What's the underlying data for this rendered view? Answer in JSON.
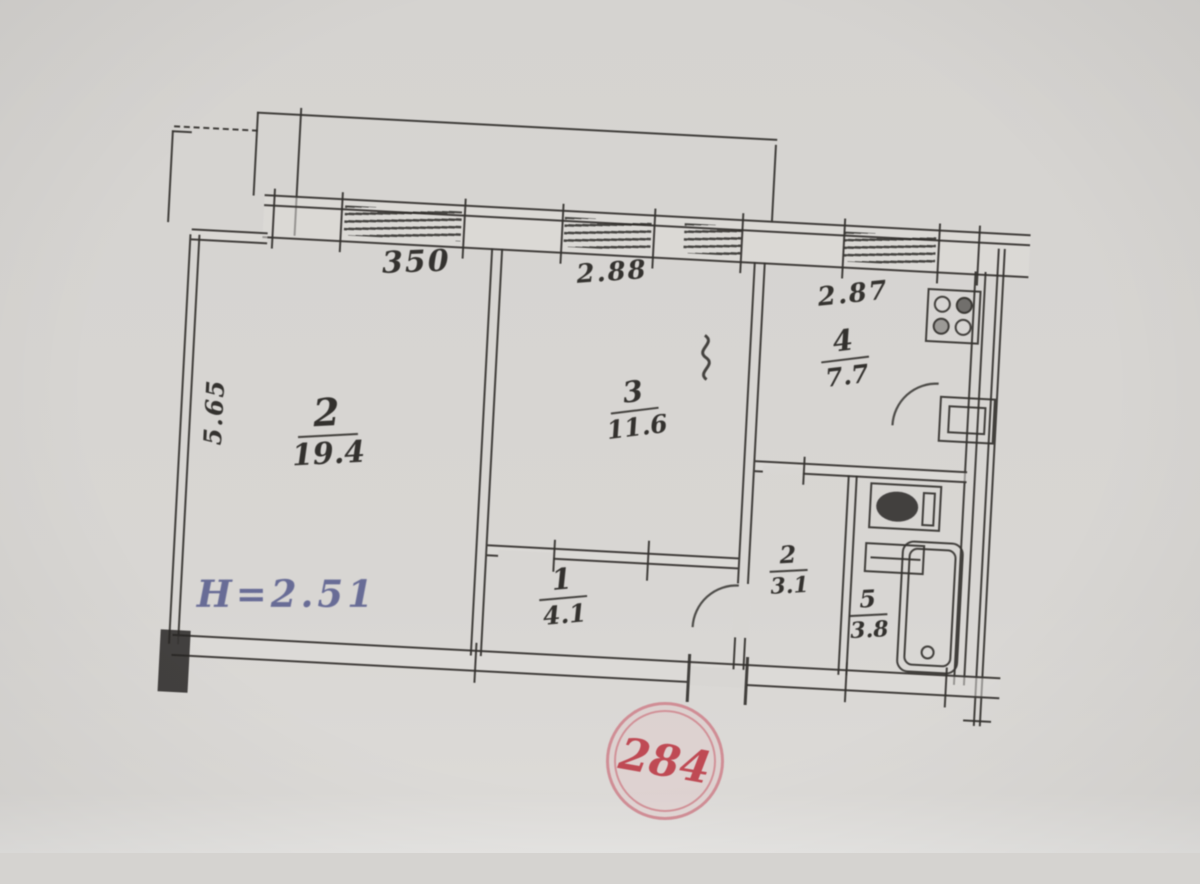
{
  "document": {
    "kind": "apartment floor plan (scanned)"
  },
  "stamp": {
    "number": "284",
    "color": "#bf4a54"
  },
  "height_note": {
    "text": "H=2.51",
    "color": "#686c96"
  },
  "dimensions": {
    "room2_width": "350",
    "room3_width": "2.88",
    "kitchen_width": "2.87",
    "left_depth": "5.65"
  },
  "rooms": [
    {
      "id": "living-room",
      "number": "2",
      "area": "19.4"
    },
    {
      "id": "bedroom",
      "number": "3",
      "area": "11.6"
    },
    {
      "id": "kitchen",
      "number": "4",
      "area": "7.7"
    },
    {
      "id": "hallway",
      "number": "1",
      "area": "4.1"
    },
    {
      "id": "corridor",
      "number": "2",
      "area": "3.1"
    },
    {
      "id": "bathroom",
      "number": "5",
      "area": "3.8"
    }
  ],
  "colors": {
    "paper": "#d8d6d3",
    "ink": "#34322f",
    "stamp_red": "#bf4a54",
    "note_blue": "#686c96"
  }
}
